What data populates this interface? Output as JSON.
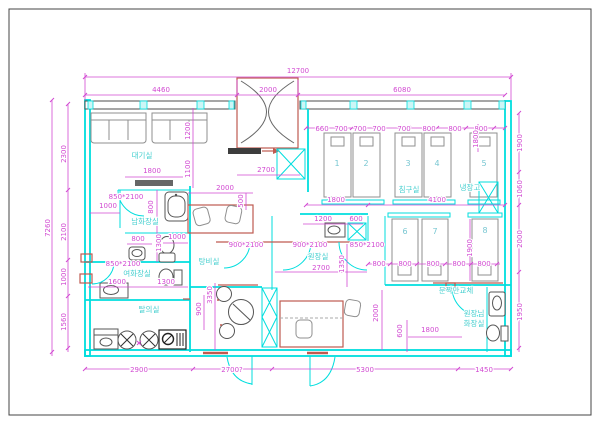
{
  "plan": {
    "rooms": {
      "waiting": "대기실",
      "mens_toilet": "남화장실",
      "womens_toilet": "여화장실",
      "changing": "탈의실",
      "pantry": "탕비실",
      "bedding": "침구실",
      "director_office": "원장실",
      "refrigerator": "냉장고",
      "door_note": "문짝만교체",
      "director_toilet_line1": "원장님",
      "director_toilet_line2": "화장실"
    },
    "bed_numbers": [
      "1",
      "2",
      "3",
      "4",
      "5",
      "6",
      "7",
      "8"
    ],
    "dims": {
      "top_overall": "12700",
      "top_left": "4460",
      "top_center": "2000",
      "top_right": "6080",
      "left_overall": "7260",
      "left_segs": [
        "2300",
        "2100",
        "1000",
        "1560"
      ],
      "right_segs": [
        "1900",
        "1060",
        "2000",
        "1950"
      ],
      "bottom_segs": [
        "2900",
        "2700?",
        "5300",
        "1450"
      ],
      "bed_top_row": [
        "660",
        "700",
        "700",
        "700",
        "700",
        "800",
        "800",
        "800"
      ],
      "bed_mid_row": [
        "800",
        "800",
        "800",
        "800",
        "800"
      ],
      "bed5_depth": "1800",
      "bed8_depth": "1900",
      "waiting_1800": "1800",
      "waiting_1100": "1100",
      "waiting_1200": "1200",
      "lobby_2700": "2700",
      "mens_door": "850*2100",
      "mens_1000": "1000",
      "mens_800v": "800",
      "desk_2000": "2000",
      "desk_500": "500",
      "mens_800": "800",
      "mens_1300": "1300",
      "mens_1000b": "1000",
      "womens_door": "850*2100",
      "womens_1600": "1600",
      "womens_1300": "1300",
      "bedding_1800": "1800",
      "bedding_4100": "4100",
      "sink_1200": "1200",
      "shaft_600": "600",
      "pantry_door": "900*2100",
      "office_door": "900*2100",
      "storage_door": "850*2100",
      "office_2700": "2700",
      "office_1350": "1350",
      "changing_3350": "3350",
      "changing_900": "900",
      "hall_2000": "2000",
      "toilet_600": "600",
      "toilet_1800": "1800"
    },
    "colors": {
      "wall_cyan": "#00dede",
      "dimension_magenta": "#d24ad2",
      "label_cyan": "#45cfcf",
      "accent_red": "#bf5a50",
      "furniture_gray": "#8f8f8f",
      "wall_dark": "#4d4d4d"
    }
  }
}
